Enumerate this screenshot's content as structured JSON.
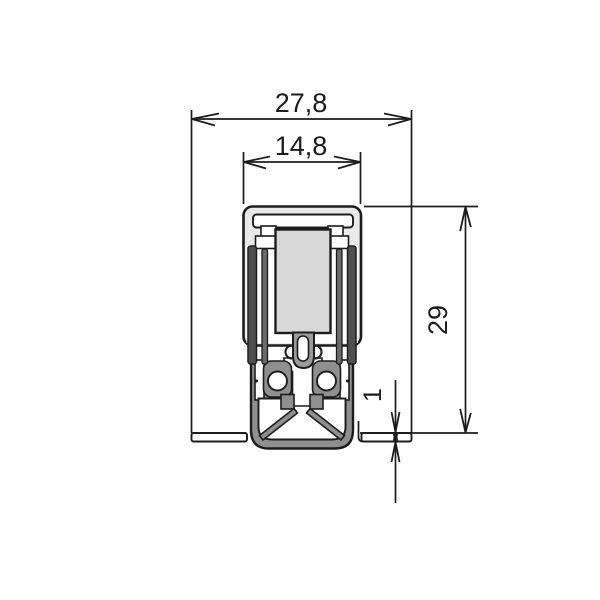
{
  "drawing": {
    "dimensions": {
      "outer_width": "27,8",
      "groove_width": "14,8",
      "profile_height": "29",
      "floor_gap": "1"
    },
    "colors": {
      "line": "#1c1c1c",
      "housing": "#e9e9e9",
      "block": "#d7d7d7",
      "rubber": "#8f8f8f",
      "fin-outer": "#4f4f4f",
      "fin-inner": "#6b6b6b",
      "tube": "#9a9a9a",
      "background": "#ffffff"
    }
  }
}
